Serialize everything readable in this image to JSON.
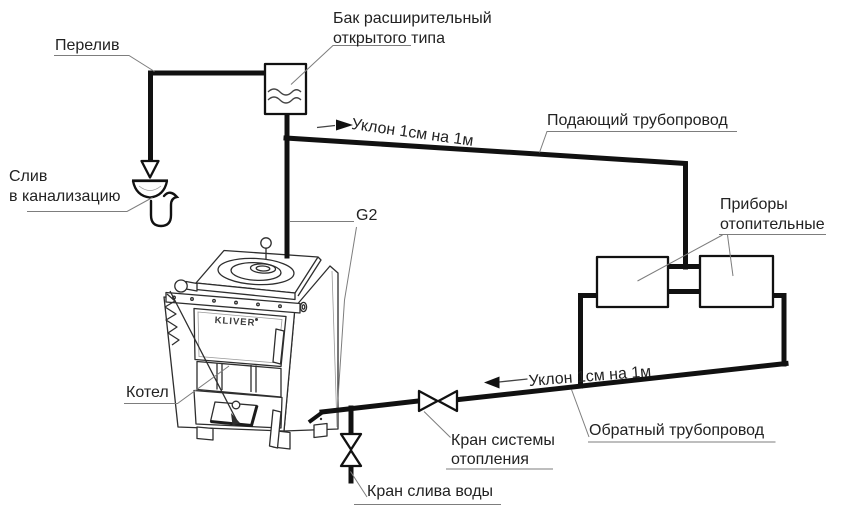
{
  "labels": {
    "overflow": "Перелив",
    "expansion_tank_line1": "Бак расширительный",
    "expansion_tank_line2": "открытого типа",
    "slope_supply": "Уклон 1см на 1м",
    "supply_pipe": "Подающий трубопровод",
    "sewer_drain_line1": "Слив",
    "sewer_drain_line2": "в канализацию",
    "connection_size": "G2",
    "heaters_line1": "Приборы",
    "heaters_line2": "отопительные",
    "boiler": "Котел",
    "slope_return": "Уклон 1см на 1м",
    "return_pipe": "Обратный трубопровод",
    "system_valve_line1": "Кран системы",
    "system_valve_line2": "отопления",
    "drain_valve": "Кран слива воды",
    "boiler_brand": "KLIVER"
  },
  "colors": {
    "pipe": "#111111",
    "leader": "#7d7d7d",
    "text": "#222222",
    "background": "#ffffff"
  }
}
